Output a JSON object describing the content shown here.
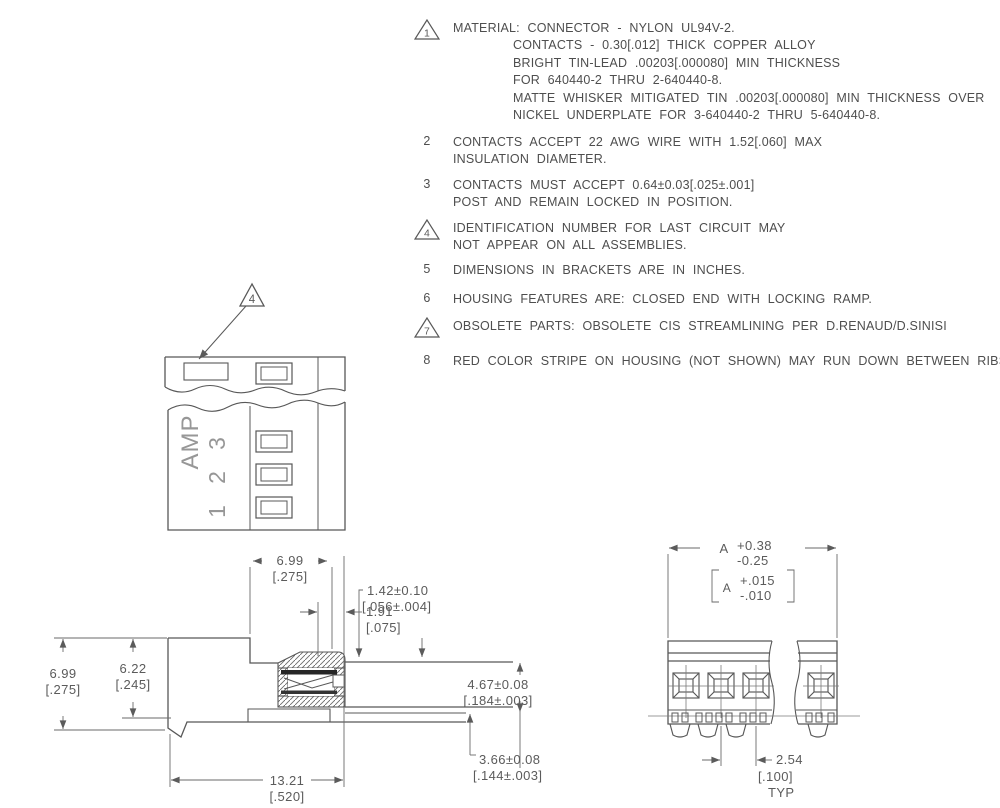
{
  "notes": [
    {
      "id": "1",
      "flagged": true,
      "lines": [
        "MATERIAL: CONNECTOR - NYLON UL94V-2.",
        "CONTACTS - 0.30[.012] THICK COPPER ALLOY",
        "BRIGHT TIN-LEAD .00203[.000080] MIN THICKNESS",
        "FOR 640440-2 THRU 2-640440-8.",
        "MATTE WHISKER MITIGATED TIN .00203[.000080] MIN THICKNESS OVER",
        "NICKEL UNDERPLATE FOR 3-640440-2 THRU 5-640440-8."
      ]
    },
    {
      "id": "2",
      "flagged": false,
      "lines": [
        "CONTACTS ACCEPT 22 AWG WIRE WITH 1.52[.060] MAX",
        "INSULATION DIAMETER."
      ]
    },
    {
      "id": "3",
      "flagged": false,
      "lines": [
        "CONTACTS MUST ACCEPT 0.64±0.03[.025±.001]",
        "POST AND REMAIN LOCKED IN POSITION."
      ]
    },
    {
      "id": "4",
      "flagged": true,
      "lines": [
        "IDENTIFICATION NUMBER FOR LAST CIRCUIT MAY",
        "NOT APPEAR ON ALL ASSEMBLIES."
      ]
    },
    {
      "id": "5",
      "flagged": false,
      "lines": [
        "DIMENSIONS IN BRACKETS ARE IN INCHES."
      ]
    },
    {
      "id": "6",
      "flagged": false,
      "lines": [
        "HOUSING FEATURES ARE: CLOSED END WITH LOCKING RAMP."
      ]
    },
    {
      "id": "7",
      "flagged": true,
      "lines": [
        "OBSOLETE PARTS: OBSOLETE CIS STREAMLINING PER D.RENAUD/D.SINISI"
      ]
    },
    {
      "id": "8",
      "flagged": false,
      "lines": [
        "RED COLOR STRIPE ON HOUSING (NOT SHOWN) MAY RUN DOWN BETWEEN RIBS."
      ]
    }
  ],
  "front": {
    "brand": "AMP",
    "circuits": [
      "1",
      "2",
      "3"
    ],
    "flag_ref": "4"
  },
  "side_dims": {
    "top_width": {
      "mm": "6.99",
      "in": "[.275]"
    },
    "overall_height": {
      "mm": "6.99",
      "in": "[.275]"
    },
    "inner_height": {
      "mm": "6.22",
      "in": "[.245]"
    },
    "offset": {
      "mm": "1.91",
      "in": "[.075]"
    },
    "wall": {
      "mm": "1.42±0.10",
      "in": "[.056±.004]"
    },
    "opening": {
      "mm": "4.67±0.08",
      "in": "[.184±.003]"
    },
    "post": {
      "mm": "3.66±0.08",
      "in": "[.144±.003]"
    },
    "length": {
      "mm": "13.21",
      "in": "[.520]"
    }
  },
  "end_dims": {
    "a": {
      "label": "A",
      "plus": "+0.38",
      "minus": "-0.25",
      "in_label": "A",
      "in_plus": "+.015",
      "in_minus": "-.010"
    },
    "pitch": {
      "mm": "2.54",
      "in": "[.100]",
      "typ": "TYP"
    }
  }
}
